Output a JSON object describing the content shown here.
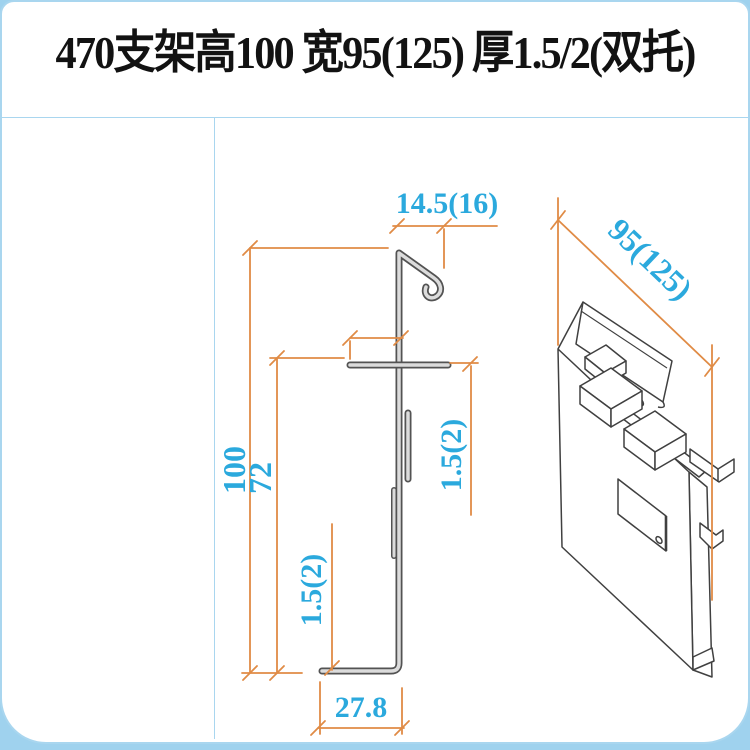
{
  "title": "470支架高100 宽95(125) 厚1.5/2(双托)",
  "views": {
    "section_label": "section-profile-view",
    "iso_label": "isometric-3d-view"
  },
  "dimensions": {
    "hook_width": "14.5(16)",
    "total_height": "100",
    "lower_height": "72",
    "flange_thickness": "1.5(2)",
    "base_thickness": "1.5(2)",
    "base_width": "27.8",
    "plate_width": "95(125)"
  },
  "colors": {
    "dimension_line": "#e08b45",
    "dimension_text": "#2ba9dd",
    "frame_border": "#a9d6ef",
    "bottom_strip": "#9fd2ee",
    "profile_fill": "#dcdcdc",
    "profile_outline": "#535353",
    "iso_line": "#404040",
    "title_text": "#121212"
  }
}
